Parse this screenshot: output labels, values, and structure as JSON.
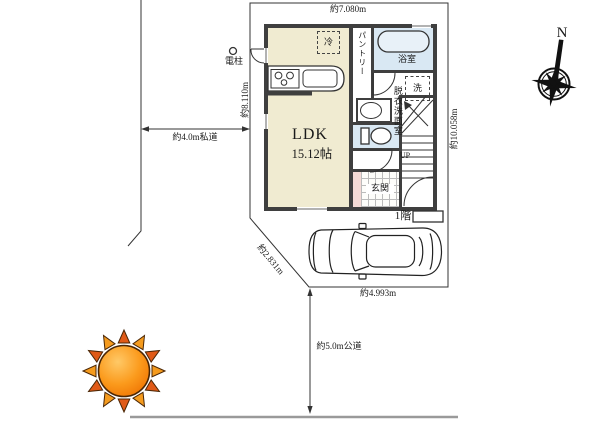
{
  "site": {
    "dim_top": "約7.080m",
    "dim_left": "約8.110m",
    "dim_right": "約10.058m",
    "dim_bottom": "約4.993m",
    "dim_diagonal": "約2.831m",
    "road_private": "約4.0m私道",
    "road_public": "約5.0m公道",
    "utility_pole": "電柱"
  },
  "floorplan": {
    "floor_label": "1階",
    "ldk_name": "LDK",
    "ldk_size": "15.12帖",
    "pantry": "パントリー",
    "bath": "浴室",
    "washroom": "脱衣洗面室",
    "washer": "洗",
    "fridge": "冷",
    "entrance": "玄関",
    "stairs_up": "UP"
  },
  "compass": {
    "north": "N"
  },
  "colors": {
    "wall": "#3f3f3f",
    "ldk_fill": "#f0ebd1",
    "wet_fill": "#d9e8f3",
    "tub_fill": "#e8f1f8",
    "pink_fill": "#f4dad6",
    "line": "#333333",
    "road_line": "#9a9a9a",
    "sun_ray_a": "#f59b1e",
    "sun_ray_b": "#e05a17",
    "sun_outline": "#4a2605"
  }
}
